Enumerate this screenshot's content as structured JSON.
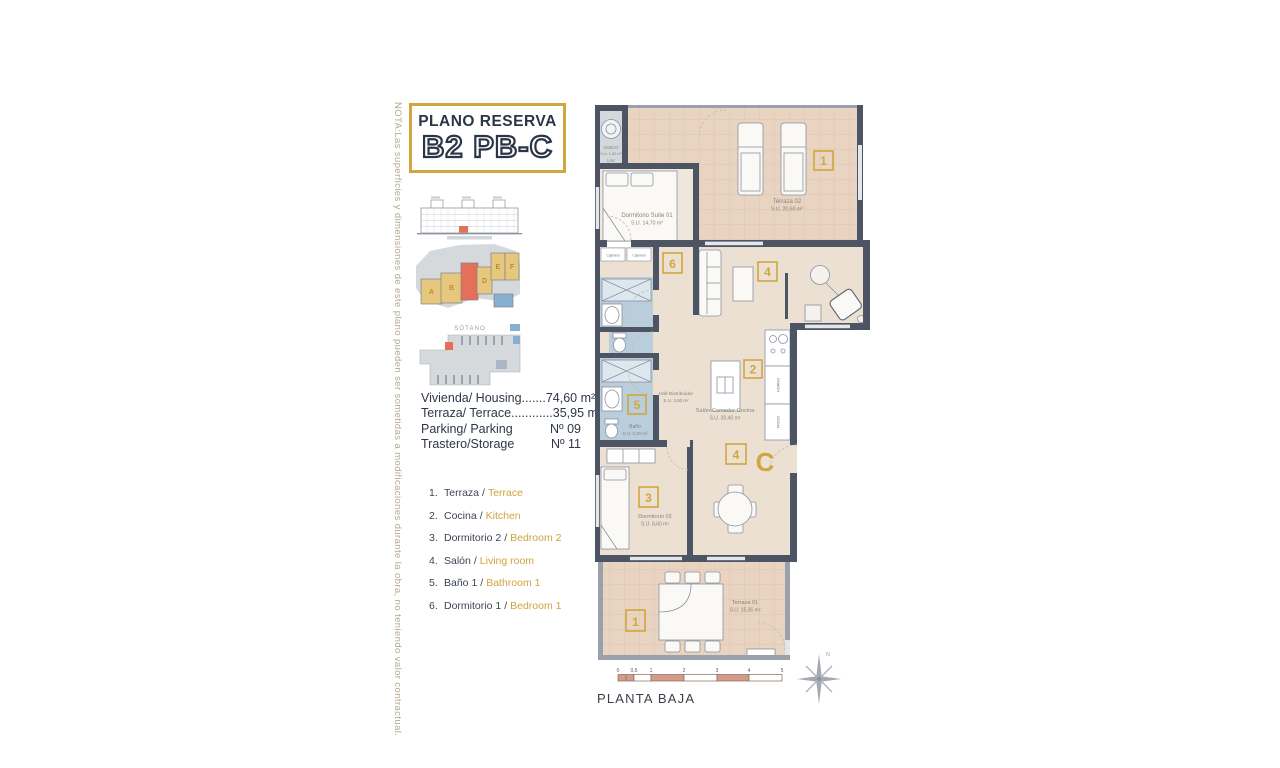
{
  "note": "NOTA:Las superficies y dimensiones de este plano pueden ser sometidas a modificaciones durante la obra, no teniendo valor contractual.",
  "title": {
    "line1": "PLANO RESERVA",
    "line2": "B2 PB-C"
  },
  "mini": {
    "sotano_label": "SÓTANO",
    "blocks": {
      "a": "A",
      "b": "B",
      "d": "D",
      "e": "E",
      "f": "F"
    }
  },
  "info": {
    "rows": [
      {
        "label": "Vivienda/ Housing",
        "dots": ".......",
        "value": "74,60 m²"
      },
      {
        "label": "Terraza/ Terrace",
        "dots": "............",
        "value": "35,95 m²"
      },
      {
        "label": "Parking/ Parking",
        "dots": "",
        "value": "Nº 09"
      },
      {
        "label": "Trastero/Storage",
        "dots": "",
        "value": "Nº 11"
      }
    ]
  },
  "legend": {
    "separator": "/",
    "items": [
      {
        "num": "1.",
        "es": "Terraza",
        "en": "Terrace"
      },
      {
        "num": "2.",
        "es": "Cocina",
        "en": "Kitchen"
      },
      {
        "num": "3.",
        "es": "Dormitorio 2",
        "en": "Bedroom 2"
      },
      {
        "num": "4.",
        "es": "Salón",
        "en": "Living room"
      },
      {
        "num": "5.",
        "es": "Baño 1",
        "en": "Bathroom 1"
      },
      {
        "num": "6.",
        "es": "Dormitorio 1",
        "en": "Bedroom 1"
      }
    ]
  },
  "plan": {
    "rooms": {
      "hueco": {
        "name": "HUECO",
        "area": "S.U. 1,60 m²",
        "extra": "LAV"
      },
      "suite": {
        "name": "Dormitorio Suite 01",
        "area": "S.U.  14,70 m²"
      },
      "terraza02": {
        "name": "Terraza 02",
        "area": "S.U. 20,60 m²"
      },
      "salon": {
        "name": "Salón-Comedor-Cocina",
        "area": "S.U. 30,40 m²"
      },
      "hall": {
        "name": "Hall-Distribuidor",
        "area": "S.U.  3,60 m²"
      },
      "bano": {
        "name": "Baño",
        "area": "S.U.  3,40 m²"
      },
      "dorm02": {
        "name": "Dormitorio 02",
        "area": "S.U.  8,60 m²"
      },
      "terraza01": {
        "name": "Terraza 01",
        "area": "S.U. 15,35 m²"
      }
    },
    "fixtures": {
      "cajonera1": "Cajonera",
      "cajonera2": "Cajonera",
      "horno": "HORNO",
      "frigo": "FRIGO"
    },
    "badges": {
      "terraza02": "1",
      "suite": "6",
      "salon": "4",
      "cocina": "2",
      "bano": "5",
      "dorm2": "3",
      "comedor": "4",
      "terraza01": "1"
    },
    "unit_letter": "C"
  },
  "footer": {
    "floor_label": "PLANTA BAJA",
    "compass_n": "N",
    "scale_ticks": [
      "0",
      "0.5",
      "1",
      "2",
      "3",
      "4",
      "5"
    ]
  },
  "colors": {
    "gold": "#d2a63e",
    "wall": "#4d5464",
    "red": "#e4705a",
    "beige": "#ece0d3",
    "terrace": "#e9d3c1",
    "bath": "#bacddb"
  }
}
